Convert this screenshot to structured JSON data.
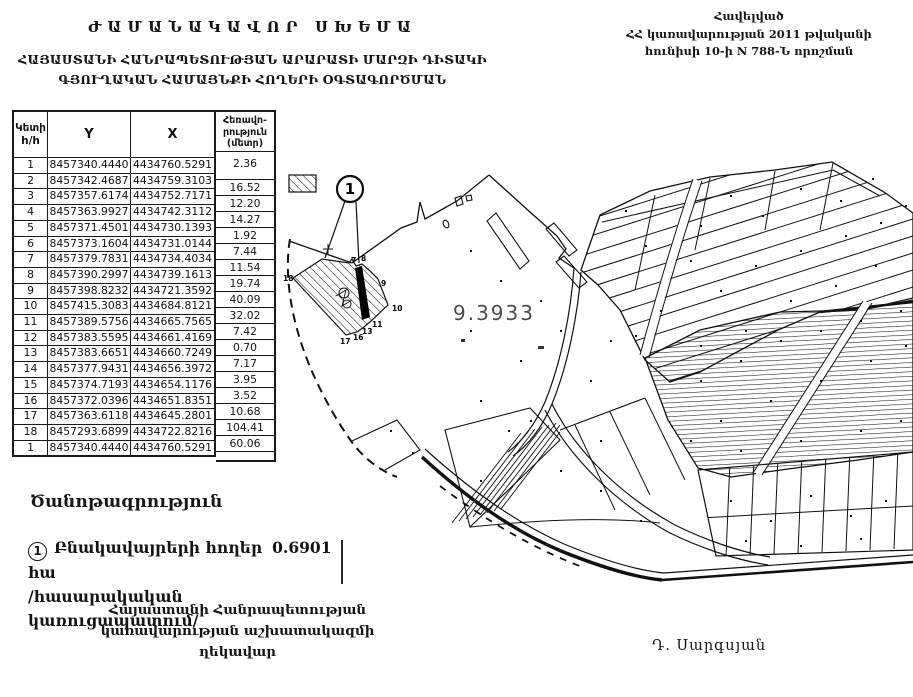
{
  "header": {
    "title": "ԺԱՄԱՆԱԿԱՎՈՐ ՍԽԵՄԱ",
    "subtitle": [
      "ՀԱՅԱՍՏԱՆԻ ՀԱՆՐԱՊԵՏՈՒԹՅԱՆ ԱՐԱՐԱՏԻ ՄԱՐԶԻ ԴԻՏԱԿԻ",
      "ԳՅՈՒՂԱԿԱՆ ՀԱՄԱՅՆՔԻ ՀՈՂԵՐԻ ՕԳՏԱԳՈՐԾՄԱՆ"
    ]
  },
  "header_right": {
    "lines": [
      "Հավելված",
      "ՀՀ կառավարության 2011 թվականի",
      "հունիսի 10-ի N 788-Ն որոշման"
    ]
  },
  "table": {
    "headers": {
      "point_line1": "Կետի",
      "point_line2": "h/h",
      "y": "Y",
      "x": "X",
      "dist_line1": "Հեռավո-",
      "dist_line2": "րություն",
      "dist_line3": "(մետր)"
    },
    "rows": [
      {
        "n": "1",
        "y": "8457340.4440",
        "x": "4434760.5291"
      },
      {
        "n": "2",
        "y": "8457342.4687",
        "x": "4434759.3103"
      },
      {
        "n": "3",
        "y": "8457357.6174",
        "x": "4434752.7171"
      },
      {
        "n": "4",
        "y": "8457363.9927",
        "x": "4434742.3112"
      },
      {
        "n": "5",
        "y": "8457371.4501",
        "x": "4434730.1393"
      },
      {
        "n": "6",
        "y": "8457373.1604",
        "x": "4434731.0144"
      },
      {
        "n": "7",
        "y": "8457379.7831",
        "x": "4434734.4034"
      },
      {
        "n": "8",
        "y": "8457390.2997",
        "x": "4434739.1613"
      },
      {
        "n": "9",
        "y": "8457398.8232",
        "x": "4434721.3592"
      },
      {
        "n": "10",
        "y": "8457415.3083",
        "x": "4434684.8121"
      },
      {
        "n": "11",
        "y": "8457389.5756",
        "x": "4434665.7565"
      },
      {
        "n": "12",
        "y": "8457383.5595",
        "x": "4434661.4169"
      },
      {
        "n": "13",
        "y": "8457383.6651",
        "x": "4434660.7249"
      },
      {
        "n": "14",
        "y": "8457377.9431",
        "x": "4434656.3972"
      },
      {
        "n": "15",
        "y": "8457374.7193",
        "x": "4434654.1176"
      },
      {
        "n": "16",
        "y": "8457372.0396",
        "x": "4434651.8351"
      },
      {
        "n": "17",
        "y": "8457363.6118",
        "x": "4434645.2801"
      },
      {
        "n": "18",
        "y": "8457293.6899",
        "x": "4434722.8216"
      },
      {
        "n": "1",
        "y": "8457340.4440",
        "x": "4434760.5291"
      }
    ],
    "distances": [
      "2.36",
      "16.52",
      "12.20",
      "14.27",
      "1.92",
      "7.44",
      "11.54",
      "19.74",
      "40.09",
      "32.02",
      "7.42",
      "0.70",
      "7.17",
      "3.95",
      "3.52",
      "10.68",
      "104.41",
      "60.06"
    ]
  },
  "map": {
    "area_label": "9.3933",
    "callout_marker": "1",
    "vertex_labels": [
      {
        "t": "18",
        "x": 283,
        "y": 281
      },
      {
        "t": "17",
        "x": 340,
        "y": 344
      },
      {
        "t": "16",
        "x": 353,
        "y": 340
      },
      {
        "t": "13",
        "x": 362,
        "y": 334
      },
      {
        "t": "11",
        "x": 372,
        "y": 327
      },
      {
        "t": "10",
        "x": 392,
        "y": 311
      },
      {
        "t": "9",
        "x": 381,
        "y": 286
      },
      {
        "t": "8",
        "x": 361,
        "y": 261
      },
      {
        "t": "7",
        "x": 351,
        "y": 263
      }
    ]
  },
  "notes": {
    "heading": "Ծանոթագրություն",
    "marker": "1",
    "line1_label": "Բնակավայրերի հողեր",
    "line1_value": "0.6901 հա",
    "line2": "/հասարակական կառուցապատում/"
  },
  "footer": {
    "org_lines": [
      "Հայաստանի Հանրապետության",
      "կառավարության աշխատակազմի",
      "ղեկավար"
    ],
    "signature": "Դ. Սարգսյան"
  }
}
